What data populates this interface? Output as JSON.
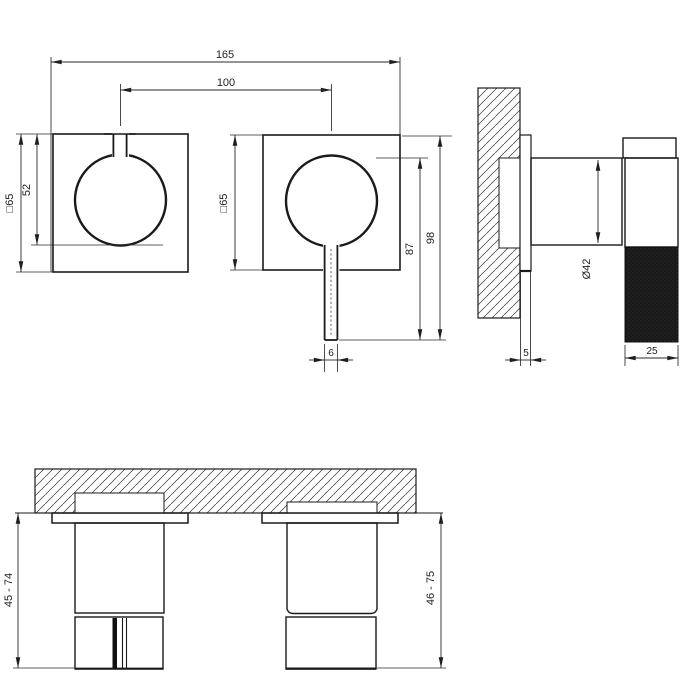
{
  "drawing": {
    "type": "technical-installation-drawing",
    "front": {
      "total_width": "165",
      "center_distance": "100",
      "plate_size_left": "□65",
      "knob_offset": "52",
      "plate_size_right": "□65",
      "lever_length": "87",
      "overall_height": "98",
      "lever_width": "6"
    },
    "side": {
      "knob_diameter": "Ø42",
      "plate_thickness": "5",
      "handle_depth": "25"
    },
    "bottom": {
      "install_depth_left": "45 - 74",
      "install_depth_right": "46 - 75"
    },
    "colors": {
      "line": "#1a1a1a",
      "background": "#ffffff",
      "knurl_fill": "#181818"
    }
  }
}
